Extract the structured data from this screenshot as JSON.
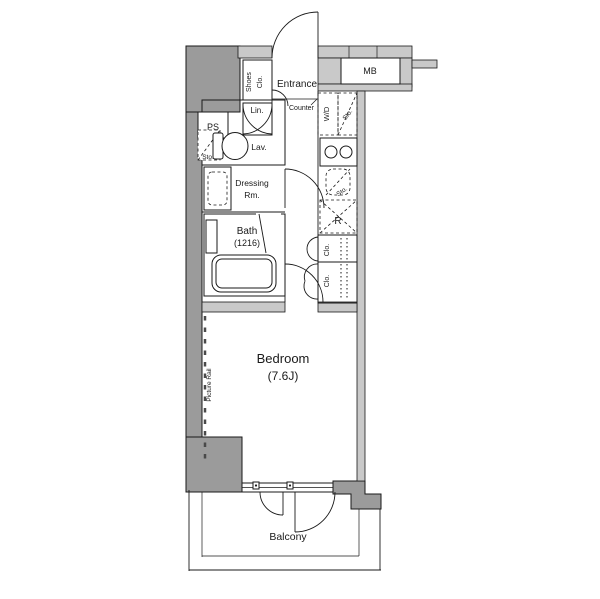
{
  "colors": {
    "wall_dark": "#9b9b9b",
    "wall_light": "#c9c9c9",
    "line": "#1a1a1a",
    "bg": "#ffffff"
  },
  "labels": {
    "entrance": "Entrance",
    "shoes_closet_line1": "Shoes",
    "shoes_closet_line2": "Clo.",
    "counter": "Counter",
    "meter_box": "MB",
    "pipe_space": "PS",
    "storage": "Sto.",
    "linen": "Lin.",
    "lavatory": "Lav.",
    "washer_dryer": "W/D",
    "dressing_line1": "Dressing",
    "dressing_line2": "Rm.",
    "bath_line1": "Bath",
    "bath_line2": "(1216)",
    "refrigerator": "R",
    "closet": "Clo.",
    "bedroom_line1": "Bedroom",
    "bedroom_line2": "(7.6J)",
    "picture_rail": "Picture Rail",
    "balcony": "Balcony"
  }
}
